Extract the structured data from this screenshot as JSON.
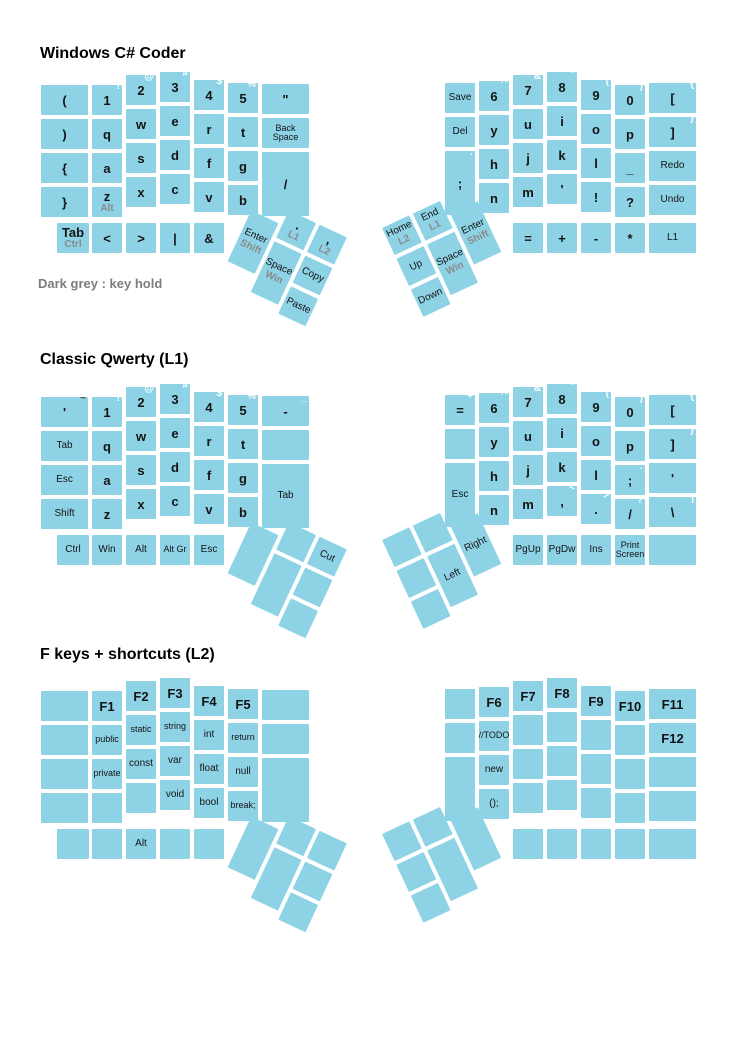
{
  "note": "Dark grey : key hold",
  "colors": {
    "key_fill": "#8ed2e6",
    "main_label": "#141414",
    "hold_label": "#8a8a8a",
    "shift_label": "#ffffff",
    "dark_shift_label": "#3f3f3f",
    "title_text": "#000000",
    "note_text": "#7d7d7d",
    "background": "#ffffff"
  },
  "geometry": {
    "unit": 30,
    "pitch": 34,
    "tall_h": 64,
    "bottom_dy": 151,
    "left_cols_x": [
      41,
      92,
      126,
      160,
      194,
      228,
      262
    ],
    "left_cols_w": [
      47,
      30,
      30,
      30,
      30,
      30,
      47
    ],
    "left_stagger": [
      13,
      13,
      3,
      0,
      8,
      11,
      12
    ],
    "right_cols_x": [
      445,
      479,
      513,
      547,
      581,
      615,
      649
    ],
    "right_cols_w": [
      30,
      30,
      30,
      30,
      30,
      30,
      47
    ],
    "right_stagger": [
      11,
      9,
      3,
      0,
      8,
      13,
      11
    ],
    "left_bottom_x": [
      57,
      92,
      126,
      160,
      194
    ],
    "left_bottom_w": [
      32,
      30,
      30,
      30,
      30
    ],
    "right_bottom_x": [
      513,
      547,
      581,
      615,
      649
    ],
    "right_bottom_w": [
      30,
      30,
      30,
      30,
      47
    ],
    "thumb": {
      "left_origin_x": 258,
      "left_dy": 124,
      "left_rot": 25,
      "right_origin_x": 382,
      "right_dy": 156,
      "right_rot": -25,
      "left_keys": [
        [
          0,
          16,
          30,
          56
        ],
        [
          34,
          0,
          30,
          30
        ],
        [
          34,
          34,
          30,
          56
        ],
        [
          68,
          0,
          30,
          30
        ],
        [
          68,
          34,
          30,
          30
        ],
        [
          68,
          68,
          30,
          30
        ]
      ],
      "right_keys": [
        [
          68,
          16,
          30,
          56
        ],
        [
          34,
          0,
          30,
          30
        ],
        [
          34,
          34,
          30,
          56
        ],
        [
          0,
          0,
          30,
          30
        ],
        [
          0,
          34,
          30,
          30
        ],
        [
          0,
          68,
          30,
          30
        ]
      ]
    }
  },
  "layouts": [
    {
      "title": "Windows C# Coder",
      "title_y": 46,
      "base_y": 72,
      "left": {
        "cols": [
          [
            {
              "t": "("
            },
            {
              "t": ")"
            },
            {
              "t": "{"
            },
            {
              "t": "}"
            }
          ],
          [
            {
              "t": "1",
              "s": "!"
            },
            {
              "t": "q"
            },
            {
              "t": "a"
            },
            {
              "t": "z",
              "h": "Alt"
            }
          ],
          [
            {
              "t": "2",
              "s": "@"
            },
            {
              "t": "w"
            },
            {
              "t": "s"
            },
            {
              "t": "x"
            }
          ],
          [
            {
              "t": "3",
              "s": "#"
            },
            {
              "t": "e"
            },
            {
              "t": "d"
            },
            {
              "t": "c"
            }
          ],
          [
            {
              "t": "4",
              "s": "$"
            },
            {
              "t": "r"
            },
            {
              "t": "f"
            },
            {
              "t": "v"
            }
          ],
          [
            {
              "t": "5",
              "s": "%"
            },
            {
              "t": "t"
            },
            {
              "t": "g"
            },
            {
              "t": "b"
            }
          ],
          [
            {
              "t": "\""
            },
            {
              "t": "Back Space"
            },
            {
              "t": "/",
              "tall": true
            },
            null
          ]
        ],
        "bottom": [
          {
            "t": "Tab",
            "h": "Ctrl",
            "bold": true
          },
          {
            "t": "<"
          },
          {
            "t": ">"
          },
          {
            "t": "|"
          },
          {
            "t": "&"
          }
        ]
      },
      "right": {
        "cols": [
          [
            {
              "t": "Save"
            },
            {
              "t": "Del"
            },
            {
              "t": ";",
              "s": ":",
              "tall": true
            },
            null
          ],
          [
            {
              "t": "6",
              "s": "^"
            },
            {
              "t": "y"
            },
            {
              "t": "h"
            },
            {
              "t": "n"
            }
          ],
          [
            {
              "t": "7",
              "s": "&"
            },
            {
              "t": "u"
            },
            {
              "t": "j"
            },
            {
              "t": "m"
            }
          ],
          [
            {
              "t": "8",
              "s": "*"
            },
            {
              "t": "i"
            },
            {
              "t": "k"
            },
            {
              "t": "'"
            }
          ],
          [
            {
              "t": "9",
              "s": "("
            },
            {
              "t": "o"
            },
            {
              "t": "l"
            },
            {
              "t": "!"
            }
          ],
          [
            {
              "t": "0",
              "s": ")"
            },
            {
              "t": "p"
            },
            {
              "t": "_"
            },
            {
              "t": "?"
            }
          ],
          [
            {
              "t": "[",
              "s": "{"
            },
            {
              "t": "]",
              "s": "}"
            },
            {
              "t": "Redo"
            },
            {
              "t": "Undo"
            }
          ]
        ],
        "bottom": [
          {
            "t": "="
          },
          {
            "t": "+"
          },
          {
            "t": "-"
          },
          {
            "t": "*"
          },
          {
            "t": "L1"
          }
        ]
      },
      "lthumb": [
        {
          "t": "Enter",
          "h": "Shift"
        },
        {
          "t": ".",
          "h": "L1"
        },
        {
          "t": "Space",
          "h": "Win"
        },
        {
          "t": ",",
          "h": "L2"
        },
        {
          "t": "Copy"
        },
        {
          "t": "Paste"
        }
      ],
      "rthumb": [
        {
          "t": "Enter",
          "h": "Shift"
        },
        {
          "t": "End",
          "h": "L1"
        },
        {
          "t": "Space",
          "h": "Win"
        },
        {
          "t": "Home",
          "h": "L2"
        },
        {
          "t": "Up"
        },
        {
          "t": "Down"
        }
      ]
    },
    {
      "title": "Classic Qwerty (L1)",
      "title_y": 352,
      "base_y": 384,
      "left": {
        "cols": [
          [
            {
              "t": "'",
              "s": "~",
              "sc": "dark"
            },
            {
              "t": "Tab"
            },
            {
              "t": "Esc"
            },
            {
              "t": "Shift"
            }
          ],
          [
            {
              "t": "1",
              "s": "!"
            },
            {
              "t": "q"
            },
            {
              "t": "a"
            },
            {
              "t": "z"
            }
          ],
          [
            {
              "t": "2",
              "s": "@"
            },
            {
              "t": "w"
            },
            {
              "t": "s"
            },
            {
              "t": "x"
            }
          ],
          [
            {
              "t": "3",
              "s": "#"
            },
            {
              "t": "e"
            },
            {
              "t": "d"
            },
            {
              "t": "c"
            }
          ],
          [
            {
              "t": "4",
              "s": "$"
            },
            {
              "t": "r"
            },
            {
              "t": "f"
            },
            {
              "t": "v"
            }
          ],
          [
            {
              "t": "5",
              "s": "%"
            },
            {
              "t": "t"
            },
            {
              "t": "g"
            },
            {
              "t": "b"
            }
          ],
          [
            {
              "t": "-",
              "s": "_"
            },
            {
              "t": ""
            },
            {
              "t": "Tab",
              "tall": true
            },
            null
          ]
        ],
        "bottom": [
          {
            "t": "Ctrl"
          },
          {
            "t": "Win"
          },
          {
            "t": "Alt"
          },
          {
            "t": "Alt Gr"
          },
          {
            "t": "Esc"
          }
        ]
      },
      "right": {
        "cols": [
          [
            {
              "t": "=",
              "s": "+"
            },
            {
              "t": ""
            },
            {
              "t": "Esc",
              "tall": true
            },
            null
          ],
          [
            {
              "t": "6",
              "s": "^"
            },
            {
              "t": "y"
            },
            {
              "t": "h"
            },
            {
              "t": "n"
            }
          ],
          [
            {
              "t": "7",
              "s": "&"
            },
            {
              "t": "u"
            },
            {
              "t": "j"
            },
            {
              "t": "m"
            }
          ],
          [
            {
              "t": "8",
              "s": "*"
            },
            {
              "t": "i"
            },
            {
              "t": "k"
            },
            {
              "t": ",",
              "s": "<"
            }
          ],
          [
            {
              "t": "9",
              "s": "("
            },
            {
              "t": "o"
            },
            {
              "t": "l"
            },
            {
              "t": ".",
              "s": ">"
            }
          ],
          [
            {
              "t": "0",
              "s": ")"
            },
            {
              "t": "p"
            },
            {
              "t": ";",
              "s": ":"
            },
            {
              "t": "/",
              "s": "?"
            }
          ],
          [
            {
              "t": "[",
              "s": "{"
            },
            {
              "t": "]",
              "s": "}"
            },
            {
              "t": "'",
              "s": "\""
            },
            {
              "t": "\\",
              "s": "|"
            }
          ]
        ],
        "bottom": [
          {
            "t": "PgUp"
          },
          {
            "t": "PgDw"
          },
          {
            "t": "Ins"
          },
          {
            "t": "Print Screen"
          },
          {
            "t": ""
          }
        ]
      },
      "lthumb": [
        {
          "t": ""
        },
        {
          "t": ""
        },
        {
          "t": ""
        },
        {
          "t": "Cut"
        },
        {
          "t": ""
        },
        {
          "t": ""
        }
      ],
      "rthumb": [
        {
          "t": "Right"
        },
        {
          "t": ""
        },
        {
          "t": "Left"
        },
        {
          "t": ""
        },
        {
          "t": ""
        },
        {
          "t": ""
        }
      ]
    },
    {
      "title": "F keys + shortcuts (L2)",
      "title_y": 647,
      "base_y": 678,
      "left": {
        "cols": [
          [
            {
              "t": ""
            },
            {
              "t": ""
            },
            {
              "t": ""
            },
            {
              "t": ""
            }
          ],
          [
            {
              "t": "F1"
            },
            {
              "t": "public"
            },
            {
              "t": "private"
            },
            {
              "t": ""
            }
          ],
          [
            {
              "t": "F2"
            },
            {
              "t": "static"
            },
            {
              "t": "const"
            },
            {
              "t": ""
            }
          ],
          [
            {
              "t": "F3"
            },
            {
              "t": "string"
            },
            {
              "t": "var"
            },
            {
              "t": "void"
            }
          ],
          [
            {
              "t": "F4"
            },
            {
              "t": "int"
            },
            {
              "t": "float"
            },
            {
              "t": "bool"
            }
          ],
          [
            {
              "t": "F5"
            },
            {
              "t": "return"
            },
            {
              "t": "null"
            },
            {
              "t": "break;"
            }
          ],
          [
            {
              "t": ""
            },
            {
              "t": ""
            },
            {
              "t": "",
              "tall": true
            },
            null
          ]
        ],
        "bottom": [
          {
            "t": ""
          },
          {
            "t": ""
          },
          {
            "t": "Alt"
          },
          {
            "t": ""
          },
          {
            "t": ""
          }
        ]
      },
      "right": {
        "cols": [
          [
            {
              "t": ""
            },
            {
              "t": ""
            },
            {
              "t": "",
              "tall": true
            },
            null
          ],
          [
            {
              "t": "F6"
            },
            {
              "t": "//TODO"
            },
            {
              "t": "new"
            },
            {
              "t": "();"
            }
          ],
          [
            {
              "t": "F7"
            },
            {
              "t": ""
            },
            {
              "t": ""
            },
            {
              "t": ""
            }
          ],
          [
            {
              "t": "F8"
            },
            {
              "t": ""
            },
            {
              "t": ""
            },
            {
              "t": ""
            }
          ],
          [
            {
              "t": "F9"
            },
            {
              "t": ""
            },
            {
              "t": ""
            },
            {
              "t": ""
            }
          ],
          [
            {
              "t": "F10"
            },
            {
              "t": ""
            },
            {
              "t": ""
            },
            {
              "t": ""
            }
          ],
          [
            {
              "t": "F11"
            },
            {
              "t": "F12"
            },
            {
              "t": ""
            },
            {
              "t": ""
            }
          ]
        ],
        "bottom": [
          {
            "t": ""
          },
          {
            "t": ""
          },
          {
            "t": ""
          },
          {
            "t": ""
          },
          {
            "t": ""
          }
        ]
      },
      "lthumb": [
        {
          "t": ""
        },
        {
          "t": ""
        },
        {
          "t": ""
        },
        {
          "t": ""
        },
        {
          "t": ""
        },
        {
          "t": ""
        }
      ],
      "rthumb": [
        {
          "t": ""
        },
        {
          "t": ""
        },
        {
          "t": ""
        },
        {
          "t": ""
        },
        {
          "t": ""
        },
        {
          "t": ""
        }
      ]
    }
  ]
}
